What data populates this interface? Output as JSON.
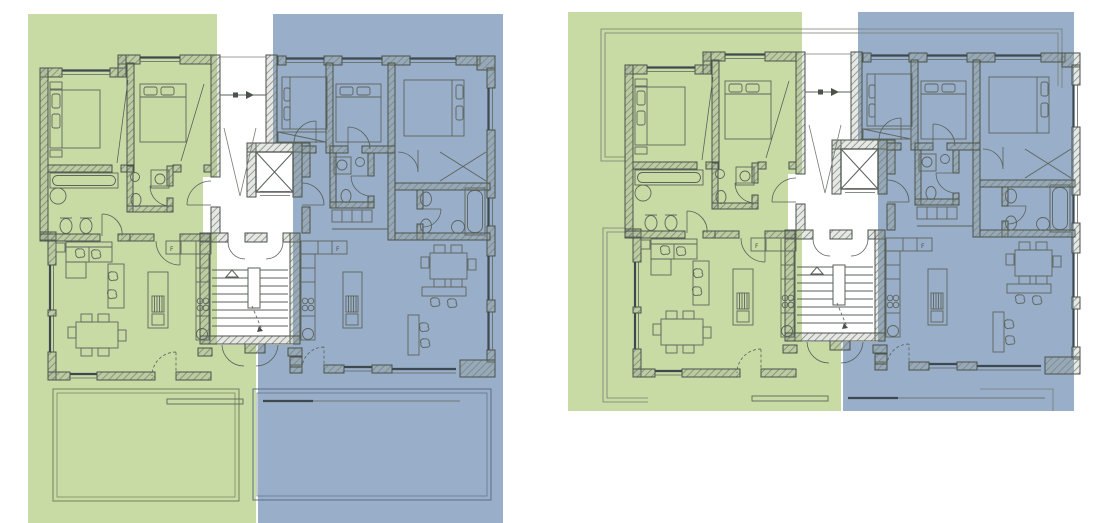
{
  "canvas": {
    "width": 1101,
    "height": 523,
    "background": "#ffffff"
  },
  "figures": [
    {
      "name": "floor-plan-with-garden-terraces",
      "position": "left"
    },
    {
      "name": "floor-plan-upper-floor",
      "position": "right"
    }
  ],
  "units": [
    {
      "id": "unit-a",
      "overlay_color": "#c8dba5",
      "outline_color": "#74805c"
    },
    {
      "id": "unit-b",
      "overlay_color": "#99aec8",
      "outline_color": "#5b7086"
    }
  ],
  "plan": {
    "fridge_label": "F"
  },
  "palette": {
    "wall_line": "#4a524a",
    "hatch_line": "#7d847a",
    "furniture_line": "#5d655d",
    "window_dark": "#3d4850",
    "lower_level_outline": "#7a8472"
  }
}
